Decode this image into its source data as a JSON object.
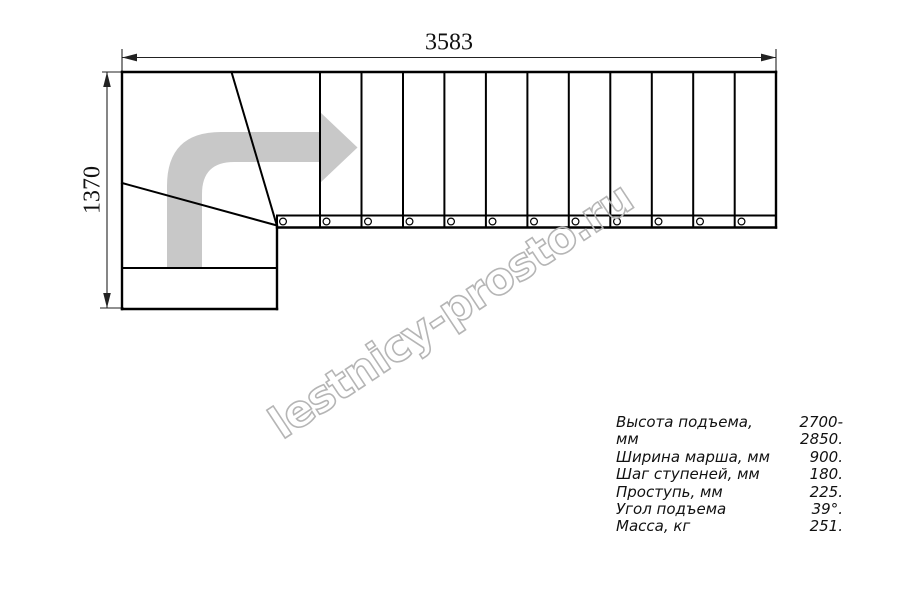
{
  "dimensions": {
    "width_mm": "3583",
    "height_mm": "1370"
  },
  "watermark": {
    "text": "lestnicy-prosto.ru",
    "color": "#b5b5b5"
  },
  "specs": {
    "rows": [
      {
        "label": "Высота подъема, мм",
        "value": "2700-2850."
      },
      {
        "label": "Ширина марша, мм",
        "value": "900."
      },
      {
        "label": "Шаг ступеней, мм",
        "value": "180."
      },
      {
        "label": "Проступь, мм",
        "value": "225."
      },
      {
        "label": "Угол подъема",
        "value": "39°."
      },
      {
        "label": "Масса, кг",
        "value": "251."
      }
    ]
  },
  "drawing": {
    "line_color": "#000000",
    "dimension_color": "#222222",
    "arrow_color": "#c8c8c8",
    "straight_tread_count": 12,
    "bolt_hole_count": 12
  }
}
